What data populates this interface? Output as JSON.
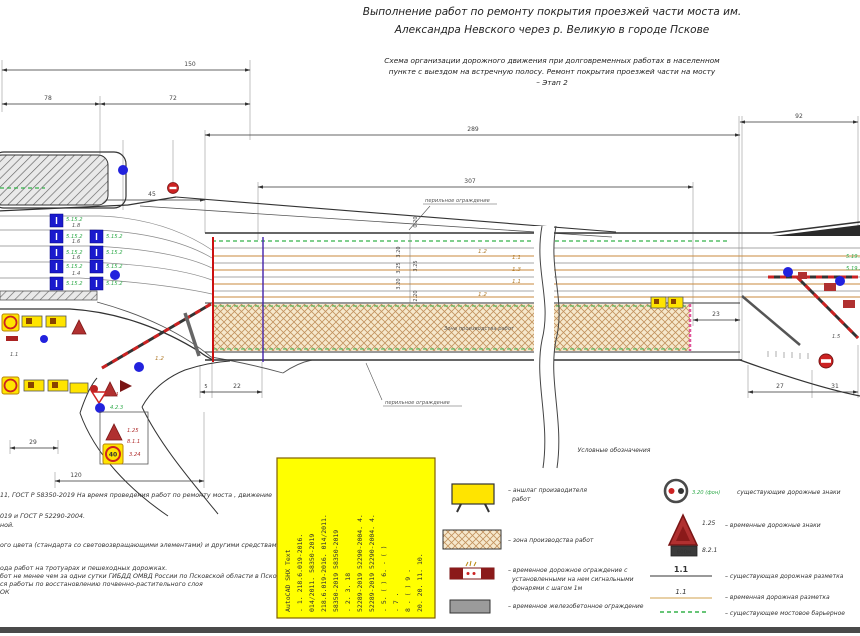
{
  "titles": {
    "line1": "Выполнение работ по ремонту покрытия проезжей части моста им.",
    "line2": "Александра Невского через р. Великую в городе Пскове",
    "sub1": "Схема организации дорожного движения при долговременных работах в населенном",
    "sub2": "пункте с выездом на встречную полосу. Ремонт покрытия проезжей части на мосту",
    "sub3": "– Этап 2"
  },
  "dims": {
    "d150": "150",
    "d78": "78",
    "d72": "72",
    "d45": "45",
    "d289": "289",
    "d307": "307",
    "d92": "92",
    "d5": "5",
    "d22": "22",
    "d23": "23",
    "d27": "27",
    "d31": "31",
    "d29": "29",
    "d120": "120"
  },
  "labels": {
    "rail_top": "перильное ограждение",
    "rail_bottom": "перильное ограждение",
    "work_zone": "Зона производства работ",
    "lane1": "1.2",
    "lane2": "1.1",
    "lane3": "1.3",
    "lane4": "1.1",
    "lane5": "1.2",
    "m11": "1.1",
    "m12": "1.2",
    "m15": "1.5",
    "m24": "2.4",
    "m423": "4.2.3",
    "vc1": "3.20",
    "vc2": "3.25",
    "vc3": "3.20",
    "vc4": "0.20",
    "vc5": "3.25",
    "vc6": "2.20",
    "s5152": "5.15.2",
    "s5191": "5.19.1",
    "s5192": "5.19.2",
    "n18": "1.8",
    "n16a": "1.6",
    "n16b": "1.6",
    "n14": "1.4",
    "box125": "1.25",
    "box811": "8.1.1",
    "box324": "3.24",
    "box40": "40"
  },
  "legend": {
    "title": "Условные обозначения",
    "board1": "–  аншлаг производителя",
    "board2": "работ",
    "zone": "–  зона производства работ",
    "fence1": "–  временное дорожное ограждение с",
    "fence2": "установленными на нем сигнальными",
    "fence3": "фонарями с шагом 1м",
    "concrete": "–  временное железобетонное ограждение",
    "sign320_label": "3.20 (фон)",
    "exist_signs": "существующие дорожные знаки",
    "sign125_label": "1.25",
    "sign821_label": "8.2.1",
    "plate600": "600м",
    "temp_signs": "–  временные дорожные знаки",
    "m11_exist": "1.1",
    "exist_marking": "–  существующая дорожная разметка",
    "m11_temp": "1.1",
    "temp_marking": "–  временная дорожная разметка",
    "bridge_barrier": "–  существующее мостовое барьерное"
  },
  "notes": {
    "l1": "11, ГОСТ Р 58350-2019  На время проведения работ по ремонту моста , движение",
    "l2": "019 и ГОСТ Р 52290-2004.",
    "l3": "ной.",
    "l4": "ого цвета (стандарта со световозвращающими элементами) и другими средствами",
    "l5": "ода работ на тротуарах и пешеходных дорожках.",
    "l6": "бот не менее чем за одни сутки ГИБДД ОМВД России по Псковской области в Пскове.",
    "l7": "ся работы по восстановлению почвенно-растительного слоя",
    "l8": "ОК"
  },
  "stamp": {
    "c1": "AutoCAD SHX Text",
    "c2": ". 1.    218.6.019-2016.",
    "c3": "014/2011.   58350-2019",
    "c4": "218.6.019-2016.  014/2011.",
    "c5": "58350-2019     58350-2019",
    "c6": ".  2.     3.   18",
    "c7": "52289-2019  52290-2004. 4.",
    "c8": "52289-2019  52290-2004. 4.",
    "c9": ". 5.   ( )   6.   - ( )",
    "c10": ". 7 .",
    "c11": "8 .  ( )   9 .",
    "c12": "20.    20. 11.    10."
  }
}
